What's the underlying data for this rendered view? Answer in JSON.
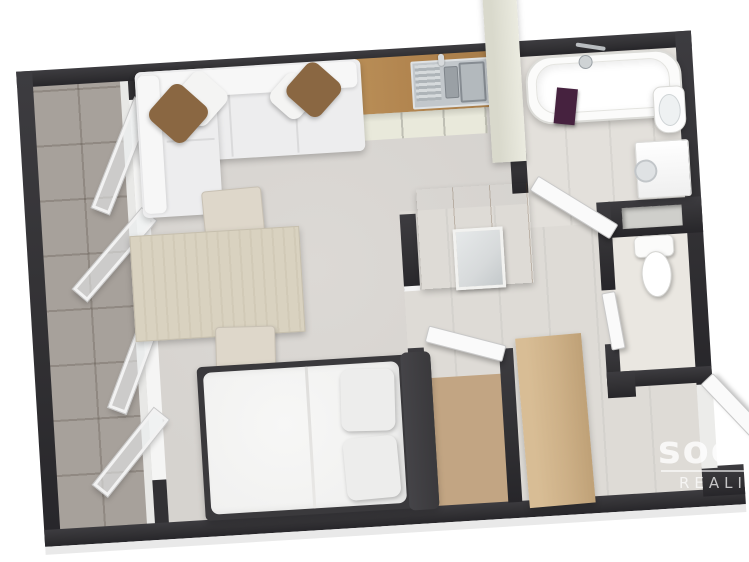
{
  "watermark": {
    "brand": "socco",
    "tagline": "REALITY"
  },
  "palette": {
    "wall": "#323134",
    "living": "#d6d3cf",
    "hall": "#dedbd6",
    "bath": "#e3e0db",
    "balcony": "#a7a19b",
    "closet": "#c2a583",
    "wcFloor": "#eae7e1",
    "wood": "#b2854f",
    "cabinetFace": "#e9e9db",
    "column": "#ebebe0",
    "wardrobeTop": "#d6bd95",
    "wardrobeFront": "#c9ac82",
    "cabinetTall": "#cdb087",
    "table": "#d9d2c0",
    "chair": "#ded7ca",
    "sofa": "#ededee",
    "sofaLight": "#f7f7f7",
    "pillowBrown": "#8a6742",
    "bed": "#f1f1f0",
    "frame": "#3a393c",
    "tub": "#fbfbfa",
    "metal": "#c2c7cb",
    "metalDark": "#9aa0a5",
    "towel": "#46223f",
    "mirror": "#d7dadb",
    "doorWhite": "#fafafa"
  }
}
